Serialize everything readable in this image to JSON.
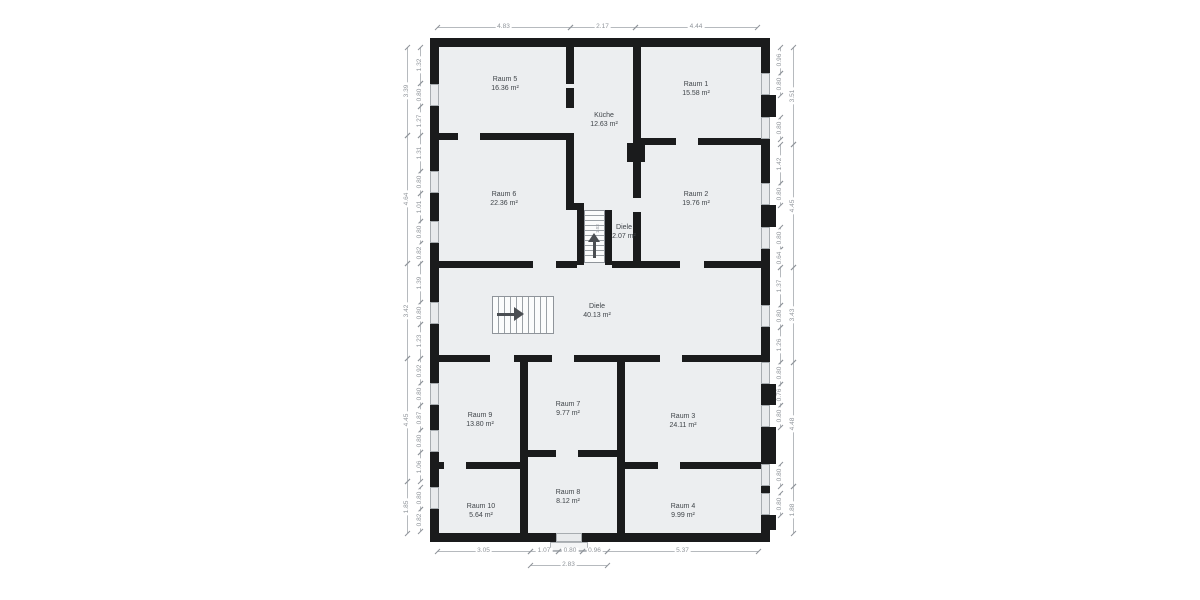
{
  "plan": {
    "rooms": [
      {
        "name": "Raum 5",
        "area": "16.36 m²"
      },
      {
        "name": "Küche",
        "area": "12.63 m²"
      },
      {
        "name": "Raum 1",
        "area": "15.58 m²"
      },
      {
        "name": "Raum 6",
        "area": "22.36 m²"
      },
      {
        "name": "Diele",
        "area": "2.07 m²"
      },
      {
        "name": "Raum 2",
        "area": "19.76 m²"
      },
      {
        "name": "Diele",
        "area": "40.13 m²"
      },
      {
        "name": "Raum 9",
        "area": "13.80 m²"
      },
      {
        "name": "Raum 7",
        "area": "9.77 m²"
      },
      {
        "name": "Raum 3",
        "area": "24.11 m²"
      },
      {
        "name": "Raum 10",
        "area": "5.64 m²"
      },
      {
        "name": "Raum 8",
        "area": "8.12 m²"
      },
      {
        "name": "Raum 4",
        "area": "9.99 m²"
      }
    ],
    "stair_dimension_label": "1.03"
  },
  "dimensions": {
    "top": [
      "4.83",
      "2.17",
      "4.44"
    ],
    "bottom": [
      "3.05",
      "1.07",
      "0.80",
      "0.96",
      "5.37"
    ],
    "bottom_overall": [
      "2.83"
    ],
    "left_totals": [
      "3.39",
      "4.64",
      "3.42",
      "4.45",
      "1.85"
    ],
    "left_segments": [
      "1.32",
      "0.80",
      "1.27",
      "1.31",
      "0.80",
      "1.01",
      "0.80",
      "0.82",
      "1.39",
      "0.80",
      "1.23",
      "0.92",
      "0.80",
      "0.87",
      "0.80",
      "1.06",
      "0.80",
      "0.82"
    ],
    "right_segments": [
      "0.96",
      "0.80",
      "0.80",
      "1.42",
      "0.80",
      "0.80",
      "0.64",
      "1.37",
      "0.80",
      "1.26",
      "0.80",
      "0.76",
      "0.80",
      "0.80",
      "0.80"
    ],
    "right_totals": [
      "3.51",
      "4.45",
      "3.43",
      "4.48",
      "1.88"
    ]
  },
  "colors": {
    "wall": "#1a1b1c",
    "floor": "#eceef0",
    "window": "#e8eaec",
    "dimension_text": "#8f949a",
    "room_text": "#3f4449",
    "stair_arrow": "#4a4e52",
    "background": "#ffffff"
  }
}
